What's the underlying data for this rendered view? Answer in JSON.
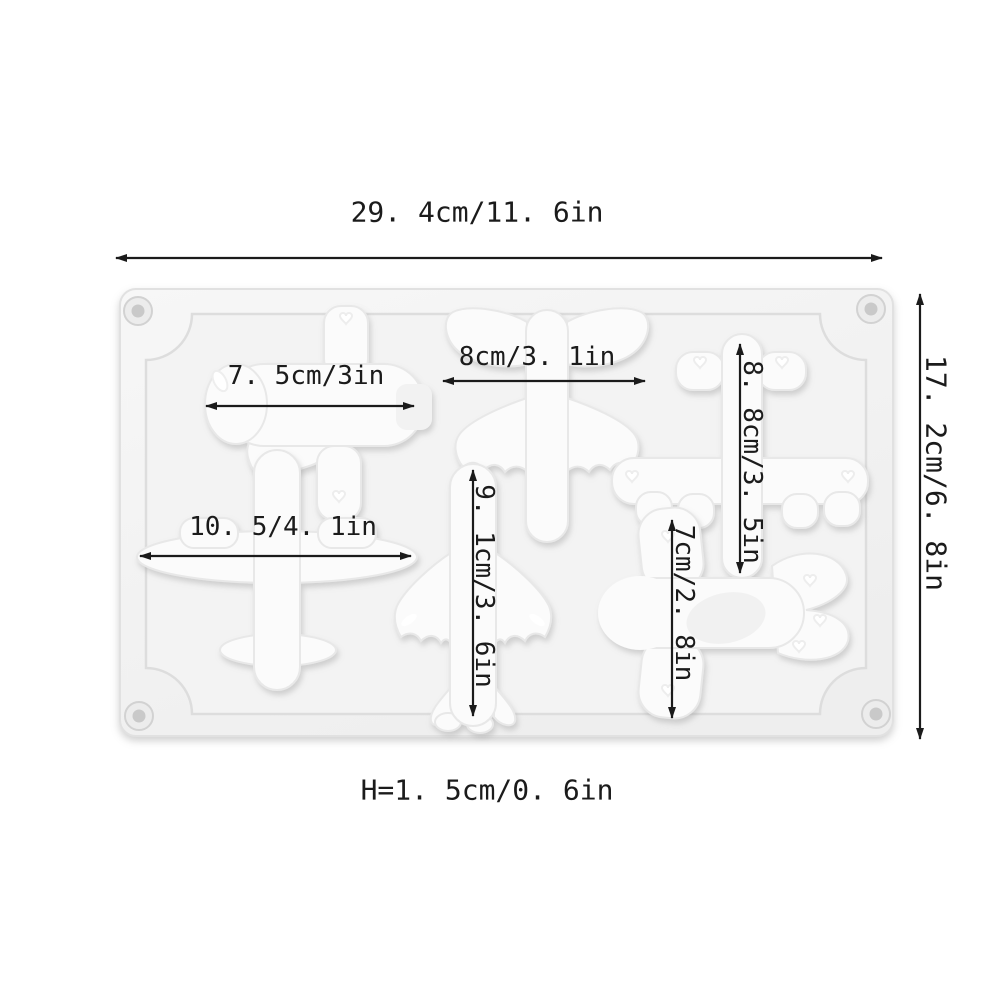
{
  "dimensions": {
    "overall_width": "29. 4cm/11. 6in",
    "overall_height": "17. 2cm/6. 8in",
    "mold_height": "H=1. 5cm/0. 6in"
  },
  "cavities": [
    {
      "name": "cartoon-plane-side-view",
      "label": "7. 5cm/3in",
      "label_orientation": "horizontal"
    },
    {
      "name": "jet-plane-top-view",
      "label": "8cm/3. 1in",
      "label_orientation": "horizontal"
    },
    {
      "name": "bomber-plane-top-view",
      "label": "8. 8cm/3. 5in",
      "label_orientation": "vertical"
    },
    {
      "name": "airliner-wide-wing",
      "label": "10. 5/4. 1in",
      "label_orientation": "horizontal"
    },
    {
      "name": "airliner-swept-wing",
      "label": "9. 1cm/3. 6in",
      "label_orientation": "vertical"
    },
    {
      "name": "cartoon-plane-heart-tail",
      "label": "7cm/2. 8in",
      "label_orientation": "vertical"
    }
  ],
  "colors": {
    "annotation": "#1b1b1b",
    "mold_face": "#f4f4f4",
    "cavity_fill": "#fbfbfb",
    "background": "#ffffff"
  }
}
